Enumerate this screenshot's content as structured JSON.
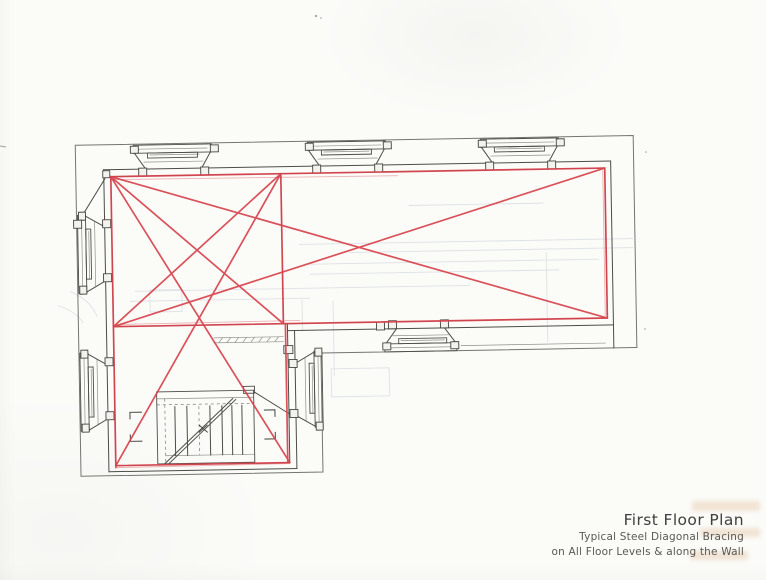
{
  "title_block": {
    "title": "First Floor Plan",
    "subtitle_line1": "Typical Steel Diagonal Bracing",
    "subtitle_line2": "on All Floor Levels & along the Wall"
  },
  "drawing": {
    "type": "architectural-floor-plan-with-steel-bracing",
    "tilt_deg": -1,
    "colors": {
      "paper": "#fbfbf8",
      "ink": "#4c4c48",
      "ink_light": "#90908a",
      "platform": "#75756f",
      "bracing_red": "#d8434d",
      "bleed": "#c7cdd9"
    },
    "plan": {
      "platform_outline": [
        [
          78,
          140
        ],
        [
          636,
          140
        ],
        [
          636,
          352
        ],
        [
          320,
          352
        ],
        [
          320,
          471
        ],
        [
          78,
          471
        ]
      ],
      "faint_lines": [
        [
          410,
          206,
          545,
          206
        ],
        [
          300,
          243,
          634,
          243
        ],
        [
          350,
          252,
          634,
          252
        ],
        [
          305,
          263,
          600,
          263
        ],
        [
          310,
          273,
          560,
          273
        ],
        [
          135,
          287,
          470,
          287
        ],
        [
          130,
          297,
          310,
          297
        ],
        [
          547,
          255,
          547,
          345
        ],
        [
          333,
          300,
          333,
          375
        ],
        [
          302,
          298,
          302,
          330
        ]
      ],
      "faint_rects": [
        [
          150,
          286,
          32,
          22
        ],
        [
          330,
          368,
          58,
          28
        ]
      ],
      "faint_arcs": [
        "M70,286 Q90,294 97,312",
        "M58,300 Q76,306 83,318"
      ],
      "light_lines": [
        [
          140,
          145,
          210,
          145
        ],
        [
          152,
          151,
          202,
          151
        ],
        [
          146,
          158,
          206,
          158
        ],
        [
          314,
          145,
          384,
          145
        ],
        [
          326,
          151,
          372,
          151
        ],
        [
          320,
          158,
          380,
          158
        ],
        [
          487,
          145,
          557,
          145
        ],
        [
          499,
          151,
          545,
          151
        ],
        [
          493,
          158,
          553,
          158
        ],
        [
          83,
          214,
          83,
          284
        ],
        [
          90,
          226,
          90,
          274
        ],
        [
          96,
          216,
          96,
          282
        ],
        [
          83,
          352,
          83,
          422
        ],
        [
          90,
          364,
          90,
          412
        ],
        [
          96,
          354,
          96,
          420
        ],
        [
          317,
          354,
          317,
          422
        ],
        [
          311,
          364,
          311,
          412
        ],
        [
          304,
          356,
          304,
          420
        ],
        [
          388,
          348,
          452,
          348
        ],
        [
          400,
          341,
          444,
          341
        ],
        [
          392,
          336,
          448,
          336
        ],
        [
          155,
          395,
          252,
          395
        ],
        [
          163,
          452,
          252,
          452
        ],
        [
          213,
          335,
          283,
          335
        ],
        [
          213,
          340,
          283,
          340
        ],
        [
          460,
          347,
          605,
          347
        ]
      ],
      "dashed_lines": [
        [
          155,
          401,
          252,
          401
        ],
        [
          163,
          395,
          163,
          458
        ],
        [
          197,
          403,
          197,
          452
        ]
      ],
      "hatch_ticks": [
        [
          218,
          340,
          222,
          335
        ],
        [
          226,
          340,
          230,
          335
        ],
        [
          234,
          340,
          238,
          335
        ],
        [
          242,
          340,
          246,
          335
        ],
        [
          250,
          340,
          254,
          335
        ],
        [
          258,
          340,
          262,
          335
        ],
        [
          266,
          340,
          270,
          335
        ],
        [
          274,
          340,
          278,
          335
        ]
      ],
      "rects": [
        [
          136,
          141,
          78,
          8
        ],
        [
          150,
          149,
          50,
          5
        ],
        [
          310,
          141,
          78,
          8
        ],
        [
          324,
          149,
          50,
          5
        ],
        [
          483,
          141,
          78,
          8
        ],
        [
          497,
          149,
          50,
          5
        ],
        [
          79,
          210,
          8,
          78
        ],
        [
          87,
          224,
          5,
          50
        ],
        [
          79,
          348,
          8,
          78
        ],
        [
          87,
          362,
          5,
          50
        ],
        [
          313,
          350,
          8,
          76
        ],
        [
          308,
          362,
          5,
          50
        ],
        [
          384,
          344,
          72,
          8
        ],
        [
          398,
          339,
          48,
          5
        ],
        [
          155,
          388,
          97,
          72
        ],
        [
          242,
          384,
          11,
          7
        ]
      ],
      "ink_lines": [
        [
          106,
          165,
          613,
          165
        ],
        [
          106,
          165,
          106,
          467
        ],
        [
          613,
          165,
          613,
          352
        ],
        [
          287,
          329,
          613,
          329
        ],
        [
          294,
          329,
          294,
          467
        ],
        [
          106,
          467,
          294,
          467
        ],
        [
          113,
          172,
          607,
          172
        ],
        [
          113,
          172,
          113,
          461
        ],
        [
          607,
          172,
          607,
          322
        ],
        [
          113,
          322,
          607,
          322
        ],
        [
          287,
          322,
          287,
          461
        ],
        [
          113,
          461,
          287,
          461
        ],
        [
          283,
          172,
          283,
          322
        ],
        [
          79,
          218,
          107,
          174
        ],
        [
          137,
          149,
          148,
          165
        ],
        [
          213,
          149,
          204,
          165
        ],
        [
          311,
          149,
          322,
          165
        ],
        [
          387,
          149,
          378,
          165
        ],
        [
          484,
          149,
          495,
          165
        ],
        [
          560,
          149,
          551,
          165
        ],
        [
          87,
          211,
          106,
          222
        ],
        [
          87,
          287,
          106,
          276
        ],
        [
          87,
          349,
          106,
          360
        ],
        [
          87,
          425,
          106,
          414
        ],
        [
          313,
          351,
          294,
          362
        ],
        [
          313,
          425,
          294,
          414
        ],
        [
          385,
          344,
          396,
          329
        ],
        [
          455,
          344,
          444,
          329
        ],
        [
          173,
          403,
          173,
          452
        ],
        [
          185,
          403,
          185,
          452
        ],
        [
          208,
          403,
          208,
          452
        ],
        [
          220,
          403,
          220,
          452
        ],
        [
          230,
          403,
          230,
          452
        ],
        [
          240,
          403,
          240,
          452
        ],
        [
          162,
          460,
          231,
          396
        ],
        [
          165,
          461,
          234,
          397
        ],
        [
          197,
          429,
          205,
          422
        ],
        [
          197,
          422,
          205,
          429
        ],
        [
          253,
          390,
          287,
          412
        ]
      ],
      "blocks": [
        [
          133,
          142,
          8,
          7
        ],
        [
          213,
          142,
          8,
          7
        ],
        [
          141,
          164,
          8,
          8
        ],
        [
          203,
          164,
          8,
          8
        ],
        [
          308,
          142,
          8,
          7
        ],
        [
          386,
          142,
          8,
          7
        ],
        [
          315,
          164,
          8,
          8
        ],
        [
          377,
          164,
          8,
          8
        ],
        [
          481,
          142,
          8,
          7
        ],
        [
          559,
          142,
          8,
          7
        ],
        [
          488,
          164,
          8,
          8
        ],
        [
          550,
          164,
          8,
          8
        ],
        [
          80,
          207,
          7,
          8
        ],
        [
          80,
          281,
          7,
          8
        ],
        [
          104,
          215,
          8,
          8
        ],
        [
          104,
          269,
          8,
          8
        ],
        [
          80,
          345,
          7,
          8
        ],
        [
          80,
          419,
          7,
          8
        ],
        [
          104,
          353,
          8,
          8
        ],
        [
          104,
          407,
          8,
          8
        ],
        [
          314,
          347,
          7,
          8
        ],
        [
          314,
          421,
          7,
          8
        ],
        [
          288,
          358,
          8,
          8
        ],
        [
          288,
          408,
          8,
          8
        ],
        [
          382,
          343,
          8,
          7
        ],
        [
          450,
          343,
          8,
          7
        ],
        [
          388,
          321,
          8,
          8
        ],
        [
          440,
          321,
          8,
          8
        ],
        [
          105,
          166,
          7,
          7
        ],
        [
          75,
          215,
          8,
          8
        ],
        [
          283,
          344,
          9,
          8
        ],
        [
          376,
          322,
          8,
          8
        ]
      ],
      "brackets": [
        "M140,408 L128,408 L128,415",
        "M128,430 L128,437 L140,437",
        "M262,408 L273,408 L273,415",
        "M273,430 L273,437 L262,437"
      ],
      "red_light_lines": [
        [
          113,
          175,
          400,
          176
        ],
        [
          115,
          320,
          300,
          319
        ],
        [
          114,
          463,
          287,
          462
        ],
        [
          605,
          174,
          605,
          320
        ]
      ],
      "red_lines": [
        [
          113,
          172,
          607,
          172
        ],
        [
          113,
          322,
          607,
          322
        ],
        [
          113,
          172,
          113,
          463
        ],
        [
          607,
          172,
          607,
          322
        ],
        [
          283,
          172,
          283,
          322
        ],
        [
          285,
          322,
          285,
          461
        ],
        [
          113,
          461,
          287,
          461
        ],
        [
          113,
          172,
          607,
          322
        ],
        [
          113,
          322,
          607,
          172
        ],
        [
          113,
          172,
          283,
          322
        ],
        [
          113,
          322,
          283,
          172
        ],
        [
          113,
          172,
          287,
          461
        ],
        [
          283,
          172,
          113,
          461
        ]
      ],
      "specks": [
        [
          316,
          16,
          1.1
        ],
        [
          321,
          18,
          0.8
        ],
        [
          646,
          152,
          0.8
        ],
        [
          645,
          329,
          0.8
        ]
      ]
    }
  }
}
